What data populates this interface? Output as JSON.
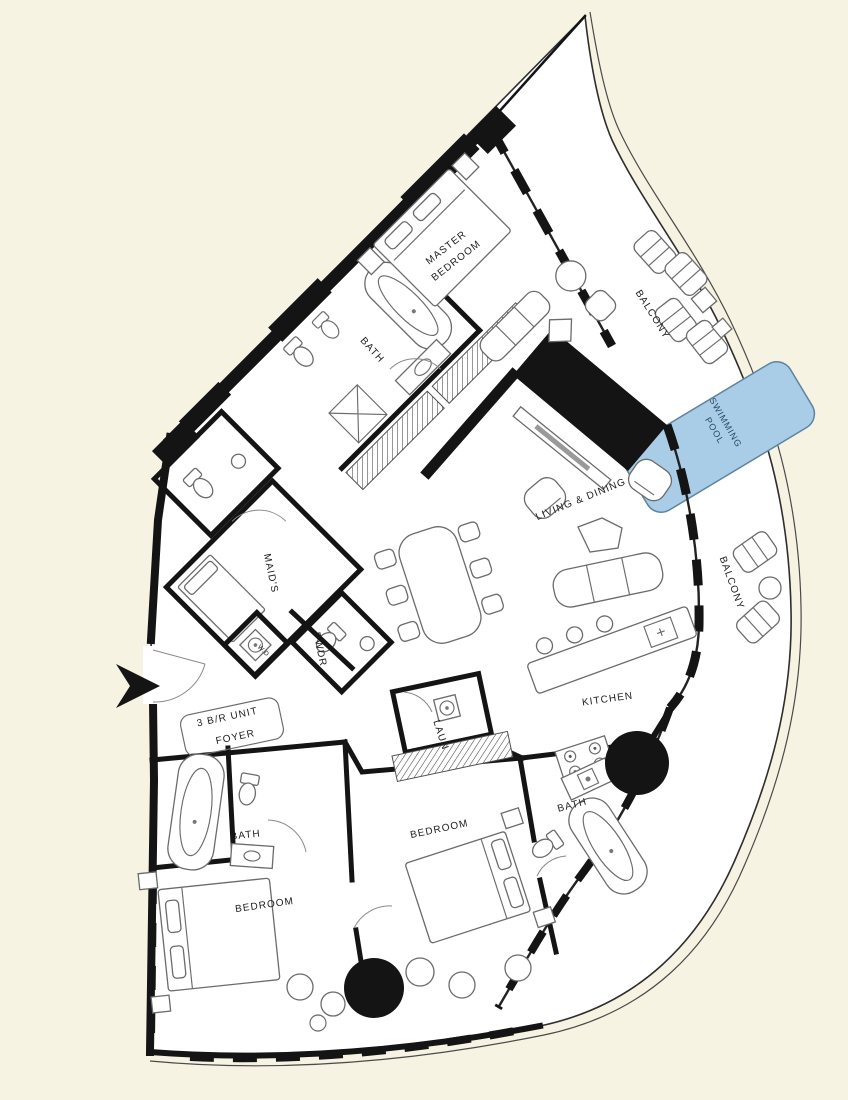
{
  "colors": {
    "background": "#f7f3e2",
    "floor": "#ffffff",
    "wall": "#141414",
    "pool": "#a9cde6",
    "pool_text": "#2a4a68"
  },
  "labels": {
    "master_bedroom_1": "MASTER",
    "master_bedroom_2": "BEDROOM",
    "master_bath": "BATH",
    "maids": "MAID'S",
    "pwdr": "PWDR",
    "wd": "W.D",
    "foyer_1": "3 B/R UNIT",
    "foyer_2": "FOYER",
    "living_dining": "LIVING & DINING",
    "kitchen": "KITCHEN",
    "laundry": "LAUN",
    "bedroom_center": "BEDROOM",
    "bedroom_left": "BEDROOM",
    "bath_center": "BATH",
    "bath_left": "BATH",
    "balcony_top": "BALCONY",
    "balcony_right": "BALCONY",
    "pool_1": "SWIMMING",
    "pool_2": "POOL"
  }
}
